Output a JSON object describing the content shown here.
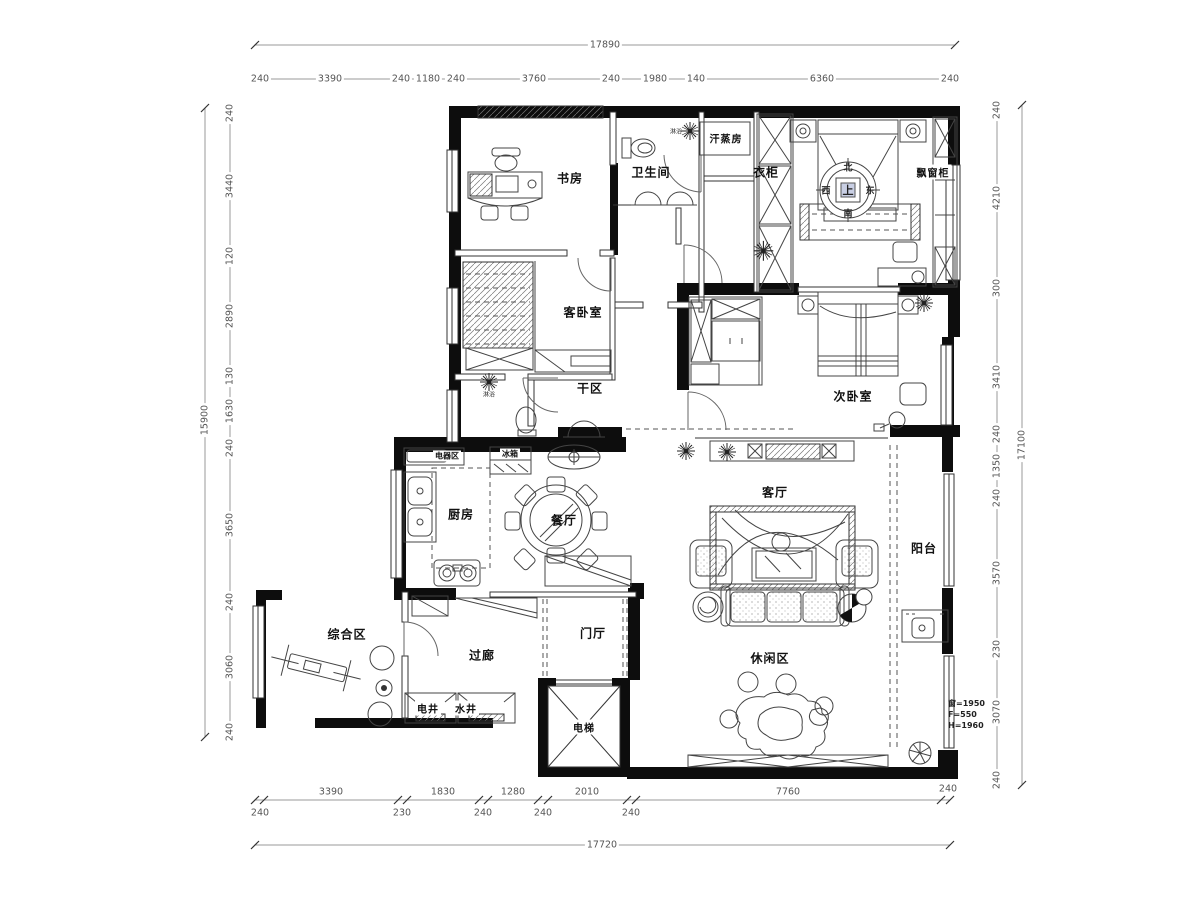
{
  "plan": {
    "rooms": {
      "study": "书房",
      "bathroom": "卫生间",
      "sauna": "汗蒸房",
      "wardrobe": "衣柜",
      "bay_cabinet": "飘窗柜",
      "guest_bedroom": "客卧室",
      "dry_area": "干区",
      "second_bedroom": "次卧室",
      "kitchen": "厨房",
      "appliance_area": "电器区",
      "fridge": "冰箱",
      "dining": "餐厅",
      "living": "客厅",
      "balcony": "阳台",
      "multi_area": "综合区",
      "corridor": "过廊",
      "foyer": "门厅",
      "electric_shaft": "电井",
      "water_shaft": "水井",
      "elevator": "电梯",
      "leisure": "休闲区",
      "shower": "淋浴"
    },
    "compass": {
      "up": "上",
      "north": "北",
      "south": "南",
      "west": "西",
      "east": "东"
    },
    "window_note": [
      "窗=1950",
      "F=550",
      "H=1960"
    ],
    "dims": {
      "top": {
        "total": "17890",
        "segments": [
          "240",
          "3390",
          "240",
          "1180",
          "240",
          "3760",
          "240",
          "1980",
          "140",
          "6360",
          "240"
        ]
      },
      "bottom": {
        "total": "17720",
        "segments": [
          "240",
          "3390",
          "230",
          "1830",
          "240",
          "1280",
          "240",
          "2010",
          "240",
          "7760",
          "240"
        ]
      },
      "left": {
        "total": "15900",
        "segments": [
          "240",
          "3440",
          "120",
          "2890",
          "130",
          "1630",
          "240",
          "3650",
          "240",
          "3060",
          "240"
        ]
      },
      "right": {
        "total": "17100",
        "segments": [
          "240",
          "4210",
          "300",
          "3410",
          "240",
          "1350",
          "240",
          "3570",
          "230",
          "3070",
          "240"
        ]
      }
    }
  }
}
